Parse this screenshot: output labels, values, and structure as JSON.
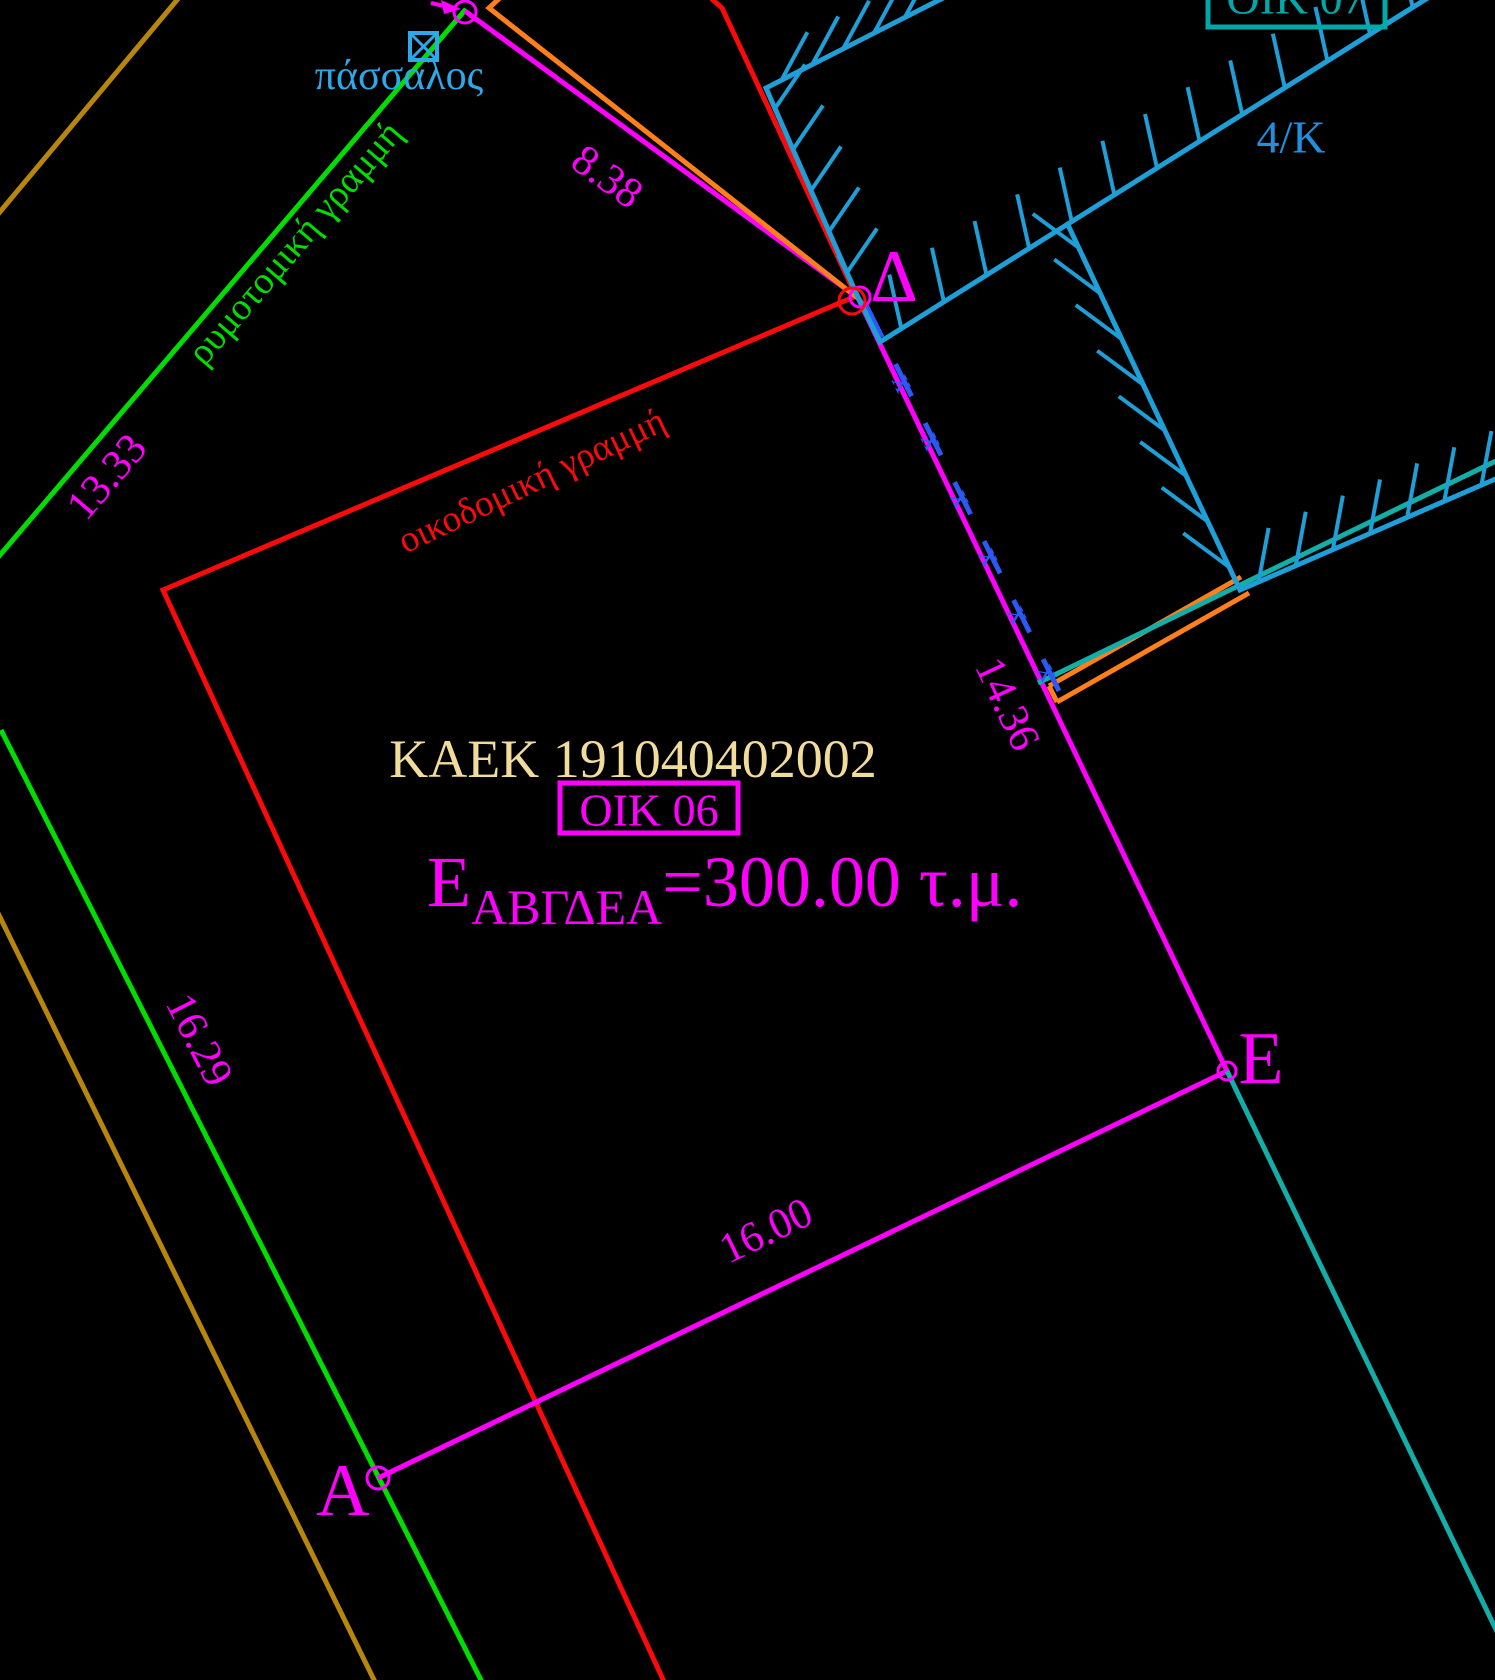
{
  "canvas": {
    "w": 1495,
    "h": 1680,
    "bg": "#000000"
  },
  "colors": {
    "magenta": "#FF00FF",
    "red": "#FA0A0A",
    "green": "#00DE00",
    "building_cyan": "#1E9FD8",
    "stake_cyan": "#2BA9E8",
    "teal_line": "#14AEA8",
    "oik07_teal": "#00A8AA",
    "block_blue": "#1E90E0",
    "xline_blue": "#2C59F6",
    "orange": "#FF7F1A",
    "goldenrod": "#B8860B",
    "kaek_wheat": "#F2DC9C"
  },
  "texts": [
    {
      "n": "stake-label",
      "t": "πάσσαλος",
      "x": 399,
      "y": 76,
      "r": 0,
      "s": 42,
      "c": "#2BA9E8"
    },
    {
      "n": "street-line-label",
      "t": "ρυμοτομική γραμμή",
      "x": 295,
      "y": 243,
      "r": -49.4,
      "s": 38,
      "c": "#00DE00"
    },
    {
      "n": "dim-13-33",
      "t": "13.33",
      "x": 107,
      "y": 477,
      "r": -49.4,
      "s": 43,
      "c": "#FF00FF"
    },
    {
      "n": "building-line-label",
      "t": "οικοδομική γραμμή",
      "x": 532,
      "y": 481,
      "r": -25.4,
      "s": 37,
      "c": "#FA0A0A"
    },
    {
      "n": "dim-8-38",
      "t": "8.38",
      "x": 607,
      "y": 177,
      "r": 36,
      "s": 43,
      "c": "#FF00FF"
    },
    {
      "n": "kaek-label",
      "t": "ΚΑΕΚ 191040402002",
      "x": 633,
      "y": 759,
      "r": 0,
      "s": 54,
      "c": "#F2DC9C"
    },
    {
      "n": "parcel-label",
      "t": "ΟΙΚ 06",
      "x": 649,
      "y": 810,
      "r": 0,
      "s": 46,
      "c": "#FF00FF"
    },
    {
      "n": "area-label",
      "x": 427,
      "y": 906,
      "r": 0,
      "s": 72,
      "c": "#FF00FF",
      "a": "start",
      "parts": [
        {
          "t": "Ε",
          "s": 72,
          "dy": 0
        },
        {
          "t": "ΑΒΓΔΕΑ",
          "s": 50,
          "dy": 18
        },
        {
          "t": "=300.00 τ.μ.",
          "s": 72,
          "dy": -18
        }
      ]
    },
    {
      "n": "dim-14-36",
      "t": "14.36",
      "x": 1007,
      "y": 704,
      "r": 65,
      "s": 43,
      "c": "#FF00FF"
    },
    {
      "n": "dim-16-29",
      "t": "16.29",
      "x": 199,
      "y": 1040,
      "r": 63,
      "s": 43,
      "c": "#FF00FF"
    },
    {
      "n": "dim-16-00",
      "t": "16.00",
      "x": 766,
      "y": 1231,
      "r": -25.6,
      "s": 43,
      "c": "#FF00FF"
    },
    {
      "n": "point-label-delta",
      "t": "Δ",
      "x": 894,
      "y": 277,
      "r": 0,
      "s": 74,
      "c": "#FF00FF"
    },
    {
      "n": "point-label-epsilon",
      "t": "Ε",
      "x": 1261,
      "y": 1059,
      "r": 0,
      "s": 74,
      "c": "#FF00FF"
    },
    {
      "n": "point-label-alpha",
      "t": "Α",
      "x": 343,
      "y": 1491,
      "r": 0,
      "s": 74,
      "c": "#FF00FF"
    },
    {
      "n": "neighbor-parcel-label",
      "t": "ΟΙΚ 07",
      "x": 1296,
      "y": -2,
      "r": 0,
      "s": 46,
      "c": "#00A8AA"
    },
    {
      "n": "block-label",
      "t": "4/Κ",
      "x": 1291,
      "y": 137,
      "r": 0,
      "s": 46,
      "c": "#1E90E0"
    }
  ],
  "lines": [
    {
      "n": "road-edge-upper",
      "p": [
        [
          182,
          -6
        ],
        [
          -6,
          219
        ]
      ],
      "c": "#B8860B",
      "w": 5
    },
    {
      "n": "road-edge-lower",
      "p": [
        [
          -6,
          905
        ],
        [
          377,
          1686
        ]
      ],
      "c": "#B8860B",
      "w": 5
    },
    {
      "n": "street-alignment-line-upper",
      "p": [
        [
          466,
          9
        ],
        [
          -6,
          562
        ]
      ],
      "c": "#00DE00",
      "w": 5
    },
    {
      "n": "street-alignment-line-lower",
      "p": [
        [
          1,
          730
        ],
        [
          484,
          1686
        ]
      ],
      "c": "#00DE00",
      "w": 5
    },
    {
      "n": "building-regulation-line",
      "p": [
        [
          704,
          -8
        ],
        [
          722,
          8
        ],
        [
          856,
          296
        ],
        [
          163,
          590
        ],
        [
          666,
          1686
        ]
      ],
      "c": "#FA0A0A",
      "w": 5
    },
    {
      "n": "parcel-boundary",
      "p": [
        [
          465,
          11
        ],
        [
          858,
          298
        ],
        [
          1227,
          1071
        ],
        [
          378,
          1478
        ]
      ],
      "c": "#FF00FF",
      "w": 5
    },
    {
      "n": "orange-fence-top",
      "p": [
        [
          503,
          -5
        ],
        [
          489,
          8
        ],
        [
          859,
          299
        ],
        [
          879,
          332
        ]
      ],
      "c": "#FF7F1A",
      "w": 5
    },
    {
      "n": "orange-wall-1",
      "p": [
        [
          1049,
          686
        ],
        [
          1241,
          577
        ]
      ],
      "c": "#FF7F1A",
      "w": 5
    },
    {
      "n": "orange-wall-2",
      "p": [
        [
          1057,
          702
        ],
        [
          1249,
          593
        ]
      ],
      "c": "#FF7F1A",
      "w": 5
    },
    {
      "n": "orange-wall-cap",
      "p": [
        [
          1049,
          686
        ],
        [
          1057,
          702
        ]
      ],
      "c": "#FF7F1A",
      "w": 5
    },
    {
      "n": "teal-boundary-upper",
      "p": [
        [
          1038,
          683
        ],
        [
          1500,
          459
        ]
      ],
      "c": "#14AEA8",
      "w": 5
    },
    {
      "n": "teal-boundary-lower",
      "p": [
        [
          1227,
          1071
        ],
        [
          1502,
          1642
        ]
      ],
      "c": "#14AEA8",
      "w": 5
    },
    {
      "n": "fence-x-line",
      "p": [
        [
          866,
          305
        ],
        [
          1059,
          691
        ]
      ],
      "c": "#2C59F6",
      "w": 5,
      "dash": "36 30"
    },
    {
      "n": "building-outline-west",
      "p": [
        [
          951,
          -6
        ],
        [
          766,
          88
        ],
        [
          856,
          293
        ],
        [
          880,
          342
        ],
        [
          1434,
          -6
        ]
      ],
      "c": "#1E9FD8",
      "w": 5
    },
    {
      "n": "building-outline-east",
      "p": [
        [
          1068,
          225
        ],
        [
          1240,
          590
        ],
        [
          1500,
          477
        ]
      ],
      "c": "#1E9FD8",
      "w": 5
    },
    {
      "n": "gamma-leader-line",
      "p": [
        [
          431,
          3
        ],
        [
          453,
          8
        ]
      ],
      "c": "#FF00FF",
      "w": 4
    }
  ],
  "hatches": [
    {
      "n": "hatch-top-edge",
      "x1": 951,
      "y1": -6,
      "x2": 766,
      "y2": 88,
      "num": 6,
      "tx": 26,
      "ty": -48
    },
    {
      "n": "hatch-west-edge",
      "x1": 766,
      "y1": 88,
      "x2": 856,
      "y2": 293,
      "num": 5,
      "tx": 30,
      "ty": -44
    },
    {
      "n": "hatch-delta-corner",
      "x1": 856,
      "y1": 293,
      "x2": 880,
      "y2": 342,
      "num": 2,
      "tx": -24,
      "ty": -50
    },
    {
      "n": "hatch-long-north-edge",
      "x1": 880,
      "y1": 342,
      "x2": 1434,
      "y2": -6,
      "num": 13,
      "tx": -12,
      "ty": -54
    },
    {
      "n": "hatch-east-edge",
      "x1": 1068,
      "y1": 225,
      "x2": 1240,
      "y2": 590,
      "num": 8,
      "tx": -46,
      "ty": -34
    },
    {
      "n": "hatch-southeast-edge",
      "x1": 1240,
      "y1": 590,
      "x2": 1500,
      "y2": 477,
      "num": 7,
      "tx": 10,
      "ty": -54
    }
  ],
  "circles": [
    {
      "n": "point-marker-gamma",
      "x": 465,
      "y": 12,
      "r": 11,
      "c": "#FF00FF"
    },
    {
      "n": "point-marker-delta",
      "x": 860,
      "y": 297,
      "r": 10,
      "c": "#FF00FF"
    },
    {
      "n": "point-marker-delta-red",
      "x": 852,
      "y": 301,
      "r": 13,
      "c": "#FA0A0A"
    },
    {
      "n": "point-marker-epsilon",
      "x": 1227,
      "y": 1071,
      "r": 9,
      "c": "#FF00FF"
    },
    {
      "n": "point-marker-alpha",
      "x": 378,
      "y": 1478,
      "r": 11,
      "c": "#FF00FF"
    }
  ],
  "polys": [
    {
      "n": "gamma-leader-arrowhead",
      "p": [
        [
          461,
          9
        ],
        [
          441,
          0
        ],
        [
          444,
          14
        ]
      ],
      "c": "#FF00FF"
    }
  ],
  "boxes": [
    {
      "n": "stake-symbol",
      "x": 410,
      "y": 33,
      "w": 27,
      "h": 27,
      "c": "#2BA9E8",
      "sw": 4,
      "cross": true
    },
    {
      "n": "parcel-label-box",
      "x": 560,
      "y": 783,
      "w": 178,
      "h": 50,
      "c": "#FF00FF",
      "sw": 5,
      "cross": false
    },
    {
      "n": "neighbor-parcel-label-box",
      "x": 1208,
      "y": -26,
      "w": 177,
      "h": 53,
      "c": "#00A8AA",
      "sw": 5,
      "cross": false
    }
  ],
  "xmarks": {
    "glyph": "x",
    "c": "#2C59F6",
    "s": 32,
    "rot": 64,
    "line": [
      866,
      305,
      1059,
      691
    ],
    "ts": [
      0.2,
      0.35,
      0.5,
      0.65,
      0.8,
      0.95
    ]
  }
}
